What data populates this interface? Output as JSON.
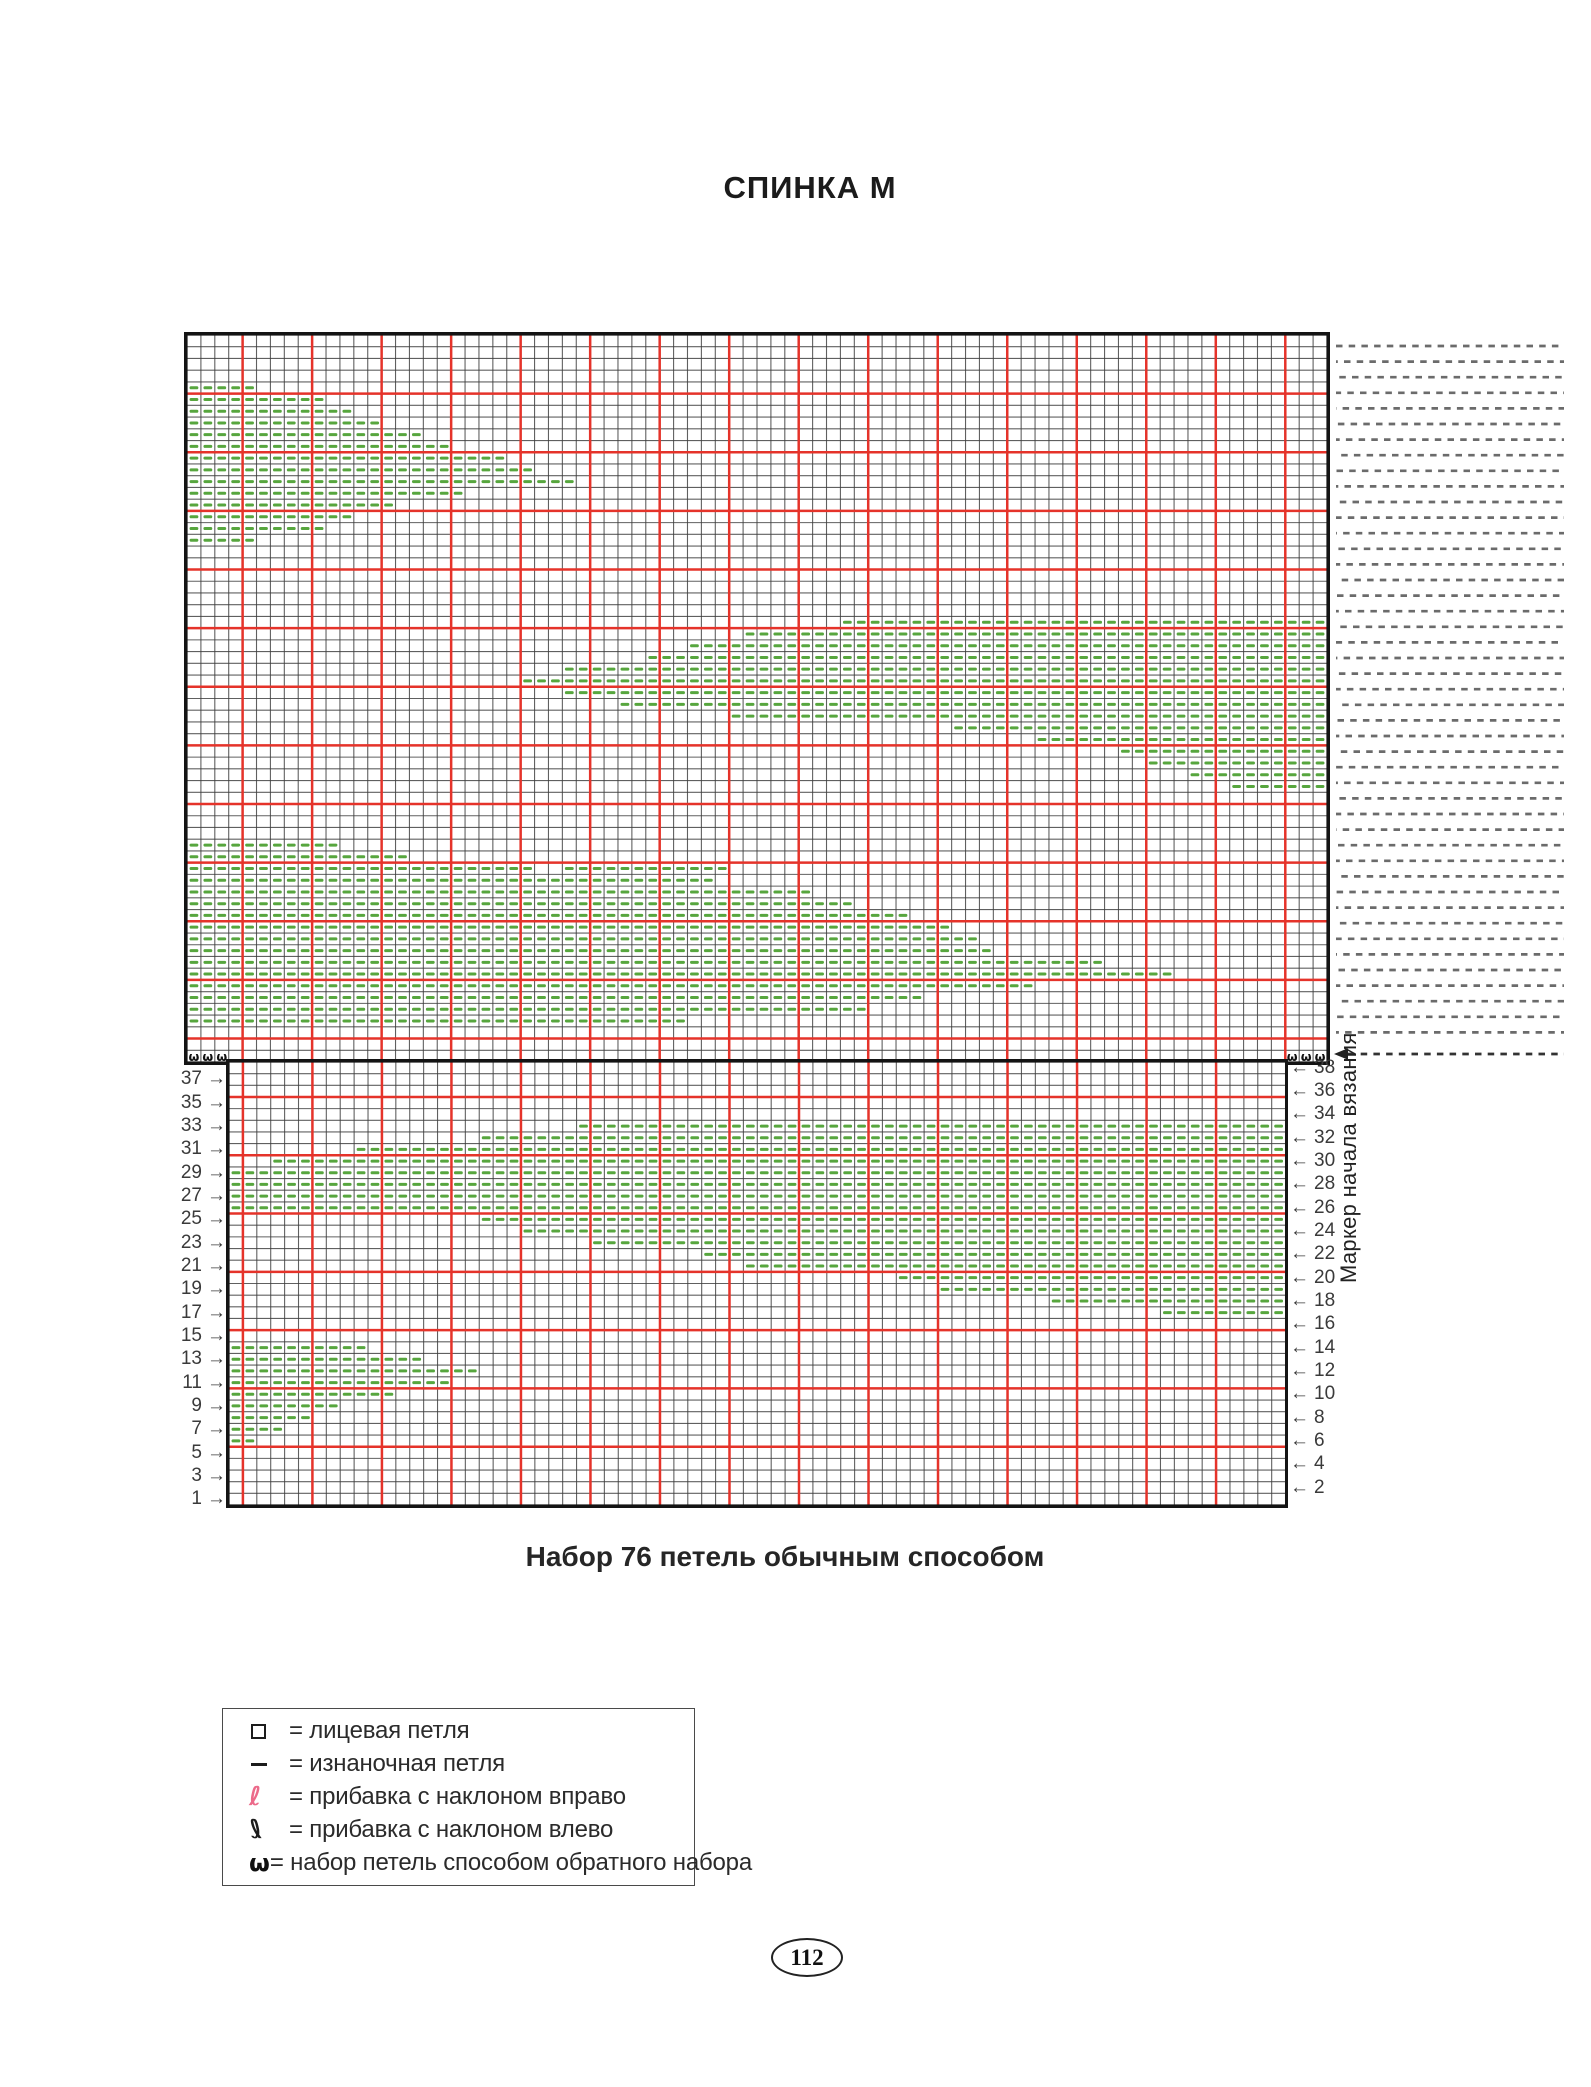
{
  "page": {
    "title": "СПИНКА М",
    "page_number": "112"
  },
  "caption": "Набор 76 петель обычным способом",
  "marker_label": "Маркер начала вязания",
  "symbols": {
    "omega": "ω",
    "loop": "ℓ",
    "arrow_left": "←",
    "arrow_right": "→"
  },
  "colors": {
    "red_grid": "#e5332a",
    "thin_grid": "#3e3e3e",
    "purl_dash": "#57a63e",
    "increase_right_pink": "#ec6a8a",
    "increase_left_black": "#1c1c1c",
    "hatch_gray": "#6b6b6b",
    "border_black": "#141414"
  },
  "legend": {
    "items": [
      {
        "symbol": "knit-square",
        "label": "= лицевая петля"
      },
      {
        "symbol": "purl-dash",
        "label": "= изнаночная петля"
      },
      {
        "symbol": "increase-right",
        "label": "= прибавка с наклоном вправо"
      },
      {
        "symbol": "increase-left",
        "label": "= прибавка с наклоном влево"
      },
      {
        "symbol": "backward-loop",
        "label": "= набор петель способом обратного набора"
      }
    ]
  },
  "chart": {
    "upper": {
      "cols": 82,
      "rows": 62,
      "omega_cells": [
        [
          62,
          1
        ],
        [
          62,
          2
        ],
        [
          62,
          3
        ],
        [
          62,
          80
        ],
        [
          62,
          81
        ],
        [
          62,
          82
        ]
      ],
      "purl_runs": {
        "5": [
          [
            1,
            5
          ]
        ],
        "6": [
          [
            1,
            10
          ]
        ],
        "7": [
          [
            1,
            12
          ]
        ],
        "8": [
          [
            1,
            14
          ]
        ],
        "9": [
          [
            1,
            17
          ]
        ],
        "10": [
          [
            1,
            19
          ]
        ],
        "11": [
          [
            1,
            23
          ]
        ],
        "12": [
          [
            1,
            25
          ]
        ],
        "13": [
          [
            1,
            28
          ]
        ],
        "14": [
          [
            1,
            20
          ]
        ],
        "15": [
          [
            1,
            15
          ]
        ],
        "16": [
          [
            1,
            12
          ]
        ],
        "17": [
          [
            1,
            10
          ]
        ],
        "18": [
          [
            1,
            5
          ]
        ],
        "25": [
          [
            48,
            82
          ]
        ],
        "26": [
          [
            41,
            82
          ]
        ],
        "27": [
          [
            37,
            82
          ]
        ],
        "28": [
          [
            34,
            82
          ]
        ],
        "29": [
          [
            28,
            82
          ]
        ],
        "30": [
          [
            25,
            82
          ]
        ],
        "31": [
          [
            28,
            82
          ]
        ],
        "32": [
          [
            32,
            82
          ]
        ],
        "33": [
          [
            40,
            82
          ]
        ],
        "34": [
          [
            56,
            82
          ]
        ],
        "35": [
          [
            62,
            82
          ]
        ],
        "36": [
          [
            68,
            82
          ]
        ],
        "37": [
          [
            70,
            82
          ]
        ],
        "38": [
          [
            73,
            82
          ]
        ],
        "39": [
          [
            76,
            82
          ]
        ],
        "44": [
          [
            1,
            11
          ]
        ],
        "45": [
          [
            1,
            16
          ]
        ],
        "46": [
          [
            1,
            25
          ],
          [
            28,
            39
          ]
        ],
        "47": [
          [
            1,
            38
          ]
        ],
        "48": [
          [
            1,
            45
          ]
        ],
        "49": [
          [
            1,
            48
          ]
        ],
        "50": [
          [
            1,
            52
          ]
        ],
        "51": [
          [
            1,
            55
          ]
        ],
        "52": [
          [
            1,
            57
          ]
        ],
        "53": [
          [
            1,
            58
          ]
        ],
        "54": [
          [
            1,
            66
          ]
        ],
        "55": [
          [
            1,
            71
          ]
        ],
        "56": [
          [
            1,
            61
          ]
        ],
        "57": [
          [
            1,
            53
          ]
        ],
        "58": [
          [
            1,
            49
          ]
        ],
        "59": [
          [
            1,
            36
          ]
        ]
      }
    },
    "lower": {
      "cols": 76,
      "rows": 38,
      "rows_numbered_from_bottom": true,
      "purl_runs": {
        "33": [
          [
            26,
            76
          ]
        ],
        "32": [
          [
            19,
            76
          ]
        ],
        "31": [
          [
            10,
            76
          ]
        ],
        "30": [
          [
            4,
            76
          ]
        ],
        "29": [
          [
            1,
            76
          ]
        ],
        "28": [
          [
            1,
            76
          ]
        ],
        "27": [
          [
            1,
            76
          ]
        ],
        "26": [
          [
            1,
            76
          ]
        ],
        "25": [
          [
            19,
            76
          ]
        ],
        "24": [
          [
            22,
            76
          ]
        ],
        "23": [
          [
            27,
            76
          ]
        ],
        "22": [
          [
            35,
            76
          ]
        ],
        "21": [
          [
            38,
            76
          ]
        ],
        "20": [
          [
            49,
            76
          ]
        ],
        "19": [
          [
            52,
            76
          ]
        ],
        "18": [
          [
            60,
            76
          ]
        ],
        "17": [
          [
            68,
            76
          ]
        ],
        "14": [
          [
            1,
            10
          ]
        ],
        "13": [
          [
            1,
            14
          ]
        ],
        "12": [
          [
            1,
            18
          ]
        ],
        "11": [
          [
            1,
            16
          ]
        ],
        "10": [
          [
            1,
            12
          ]
        ],
        "9": [
          [
            1,
            8
          ]
        ],
        "8": [
          [
            1,
            6
          ]
        ],
        "7": [
          [
            1,
            4
          ]
        ],
        "6": [
          [
            1,
            2
          ]
        ]
      }
    },
    "left_row_numbers": [
      37,
      35,
      33,
      31,
      29,
      27,
      25,
      23,
      21,
      19,
      17,
      15,
      13,
      11,
      9,
      7,
      5,
      3,
      1
    ],
    "right_row_numbers": [
      38,
      36,
      34,
      32,
      30,
      28,
      26,
      24,
      22,
      20,
      18,
      16,
      14,
      12,
      10,
      8,
      6,
      4,
      2
    ]
  }
}
